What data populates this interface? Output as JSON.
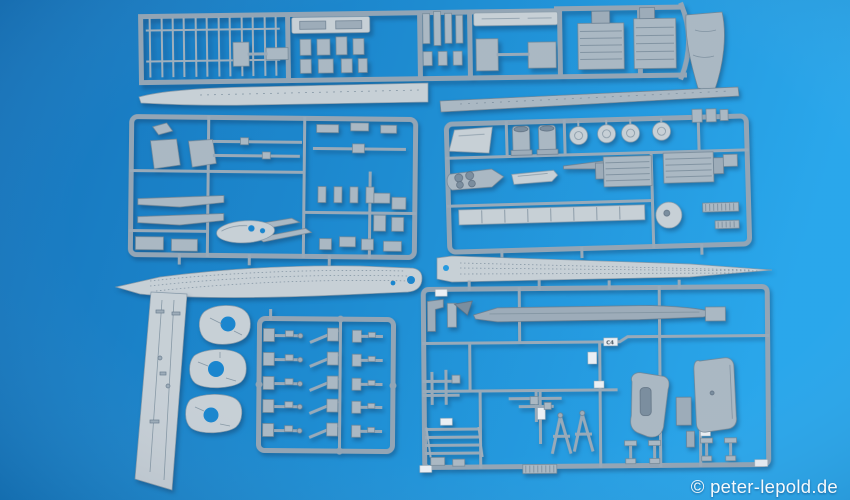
{
  "watermark": {
    "text": "© peter-lepold.de",
    "color": "#ffffff"
  },
  "scene": {
    "subject": "Grey plastic model warship kit sprues photographed on a blue surface",
    "background_left": "#0a6db8",
    "background_mid": "#1286cf",
    "background_right": "#1fa2ea",
    "plastic_light": "#c4cdd4",
    "plastic_mid": "#a6b4c0",
    "plastic_base": "#8da0b1",
    "plastic_dark": "#64788a",
    "shadow": "rgba(4,42,84,0.4)"
  },
  "part_tags": {
    "visible": "C4"
  },
  "objects": [
    {
      "name": "railing-and-decks-sprue",
      "area": "top"
    },
    {
      "name": "stern-hull-part",
      "area": "top-right"
    },
    {
      "name": "port-hull-half",
      "area": "upper-left"
    },
    {
      "name": "starboard-hull-half",
      "area": "upper-right"
    },
    {
      "name": "superstructure-parts-sprue",
      "area": "middle-left"
    },
    {
      "name": "funnels-and-turrets-sprue",
      "area": "middle-right"
    },
    {
      "name": "fore-deck-part",
      "area": "center-left"
    },
    {
      "name": "aft-deck-part",
      "area": "center-right"
    },
    {
      "name": "hull-bottom-plate",
      "area": "bottom-left"
    },
    {
      "name": "turret-base-discs",
      "area": "bottom-left",
      "count": 3
    },
    {
      "name": "aa-guns-sprue",
      "area": "bottom-center"
    },
    {
      "name": "masts-and-fittings-sprue",
      "area": "bottom-right"
    }
  ]
}
